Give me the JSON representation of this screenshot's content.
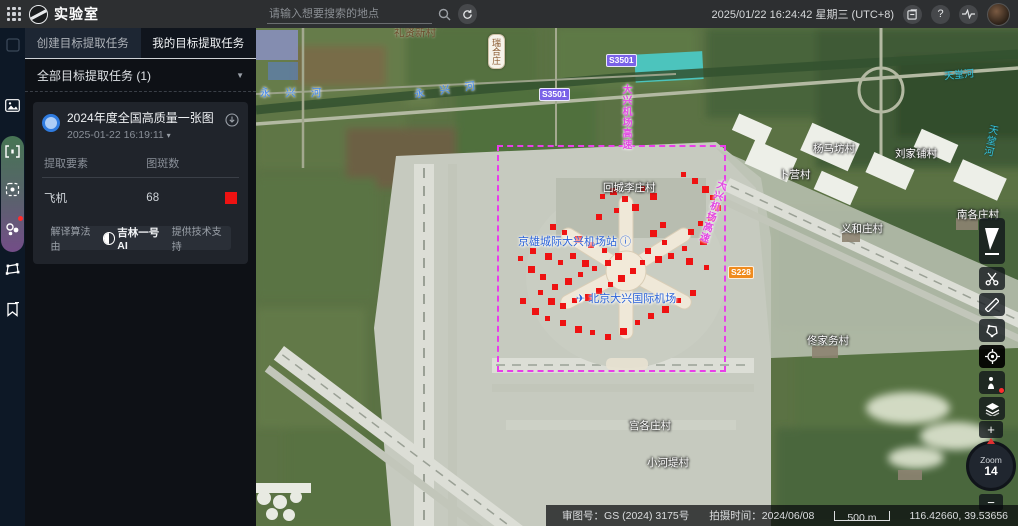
{
  "app": {
    "title": "实验室"
  },
  "topbar": {
    "search_placeholder": "请输入想要搜索的地点",
    "datetime": "2025/01/22 16:24:42 星期三 (UTC+8)",
    "help_glyph": "?"
  },
  "panel": {
    "tabs": [
      {
        "label": "创建目标提取任务",
        "active": false
      },
      {
        "label": "我的目标提取任务",
        "active": true
      }
    ],
    "filter_label": "全部目标提取任务 (1)",
    "task": {
      "title": "2024年度全国高质量一张图",
      "time": "2025-01-22 16:19:11",
      "table": {
        "headers": [
          "提取要素",
          "图斑数"
        ],
        "rows": [
          {
            "name": "飞机",
            "count": "68",
            "color": "#ee1212"
          }
        ]
      },
      "algo_prefix": "解译算法由",
      "algo_brand": "吉林一号AI",
      "algo_suffix": "提供技术支持"
    }
  },
  "map": {
    "selection_rect": {
      "x": 241,
      "y": 117,
      "w": 225,
      "h": 223
    },
    "labels": [
      {
        "text": "礼贤新村",
        "x": 138,
        "y": -3,
        "cls": "town-dark"
      },
      {
        "text": "瑞合庄",
        "x": 232,
        "y": 6,
        "cls": "pill-vert"
      },
      {
        "text": "永 兴 河",
        "x": 4,
        "y": 57,
        "cls": "river-blue"
      },
      {
        "text": "永 兴 河",
        "x": 158,
        "y": 54,
        "cls": "river-blue",
        "rot": -8
      },
      {
        "text": "大兴机场高速",
        "x": 362,
        "y": 56,
        "cls": "road-magenta vert"
      },
      {
        "text": "大兴机场高速",
        "x": 448,
        "y": 150,
        "cls": "road-magenta vert",
        "rot": 18
      },
      {
        "text": "回城李庄村",
        "x": 347,
        "y": 152,
        "cls": "place"
      },
      {
        "text": "京雄城际大兴机场站 ⓘ",
        "x": 262,
        "y": 205,
        "cls": "poi-blue"
      },
      {
        "text": "✈ 北京大兴国际机场",
        "x": 320,
        "y": 262,
        "cls": "poi-blue"
      },
      {
        "text": "杨马坊村",
        "x": 557,
        "y": 113,
        "cls": "place"
      },
      {
        "text": "刘家铺村",
        "x": 639,
        "y": 118,
        "cls": "place"
      },
      {
        "text": "卜营村",
        "x": 523,
        "y": 139,
        "cls": "place"
      },
      {
        "text": "南各庄村",
        "x": 701,
        "y": 179,
        "cls": "place"
      },
      {
        "text": "义和庄村",
        "x": 585,
        "y": 193,
        "cls": "place"
      },
      {
        "text": "佟家务村",
        "x": 551,
        "y": 305,
        "cls": "place"
      },
      {
        "text": "宫各庄村",
        "x": 373,
        "y": 390,
        "cls": "place"
      },
      {
        "text": "小河堤村",
        "x": 391,
        "y": 427,
        "cls": "place"
      },
      {
        "text": "天堂河",
        "x": 688,
        "y": 38,
        "cls": "river-cyan",
        "rot": -6
      },
      {
        "text": "天堂河",
        "x": 726,
        "y": 96,
        "cls": "river-cyan vert",
        "rot": 12
      }
    ],
    "shields": [
      {
        "text": "S3501",
        "x": 283,
        "y": 60,
        "color": "#7a62e8"
      },
      {
        "text": "S3501",
        "x": 350,
        "y": 26,
        "color": "#7a62e8"
      },
      {
        "text": "S228",
        "x": 472,
        "y": 238,
        "color": "#ef8b1e"
      }
    ],
    "detections": [
      [
        425,
        144
      ],
      [
        436,
        150
      ],
      [
        446,
        158
      ],
      [
        454,
        167
      ],
      [
        459,
        177
      ],
      [
        452,
        186
      ],
      [
        442,
        193
      ],
      [
        432,
        201
      ],
      [
        444,
        210
      ],
      [
        426,
        218
      ],
      [
        412,
        225
      ],
      [
        430,
        230
      ],
      [
        448,
        237
      ],
      [
        404,
        194
      ],
      [
        394,
        202
      ],
      [
        406,
        212
      ],
      [
        389,
        220
      ],
      [
        399,
        228
      ],
      [
        384,
        232
      ],
      [
        374,
        240
      ],
      [
        362,
        247
      ],
      [
        352,
        254
      ],
      [
        340,
        260
      ],
      [
        329,
        266
      ],
      [
        316,
        270
      ],
      [
        304,
        275
      ],
      [
        292,
        270
      ],
      [
        282,
        262
      ],
      [
        296,
        256
      ],
      [
        309,
        250
      ],
      [
        322,
        244
      ],
      [
        284,
        246
      ],
      [
        272,
        238
      ],
      [
        262,
        228
      ],
      [
        274,
        220
      ],
      [
        289,
        225
      ],
      [
        302,
        232
      ],
      [
        314,
        225
      ],
      [
        326,
        232
      ],
      [
        336,
        238
      ],
      [
        349,
        232
      ],
      [
        359,
        225
      ],
      [
        346,
        220
      ],
      [
        332,
        214
      ],
      [
        319,
        208
      ],
      [
        306,
        202
      ],
      [
        294,
        196
      ],
      [
        354,
        160
      ],
      [
        344,
        166
      ],
      [
        366,
        168
      ],
      [
        376,
        176
      ],
      [
        358,
        180
      ],
      [
        340,
        186
      ],
      [
        394,
        165
      ],
      [
        384,
        158
      ],
      [
        264,
        270
      ],
      [
        276,
        280
      ],
      [
        289,
        288
      ],
      [
        304,
        292
      ],
      [
        319,
        298
      ],
      [
        334,
        302
      ],
      [
        349,
        306
      ],
      [
        364,
        300
      ],
      [
        379,
        292
      ],
      [
        392,
        285
      ],
      [
        406,
        278
      ],
      [
        420,
        270
      ],
      [
        434,
        262
      ]
    ]
  },
  "map_tools": {
    "zoom_word": "Zoom",
    "zoom_level": "14",
    "zoom_in": "+",
    "zoom_out": "−"
  },
  "statusbar": {
    "license": "审图号：GS (2024) 3175号",
    "capture": "拍摄时间：2024/06/08",
    "scale": "500 m",
    "coords": "116.42660, 39.53656"
  }
}
